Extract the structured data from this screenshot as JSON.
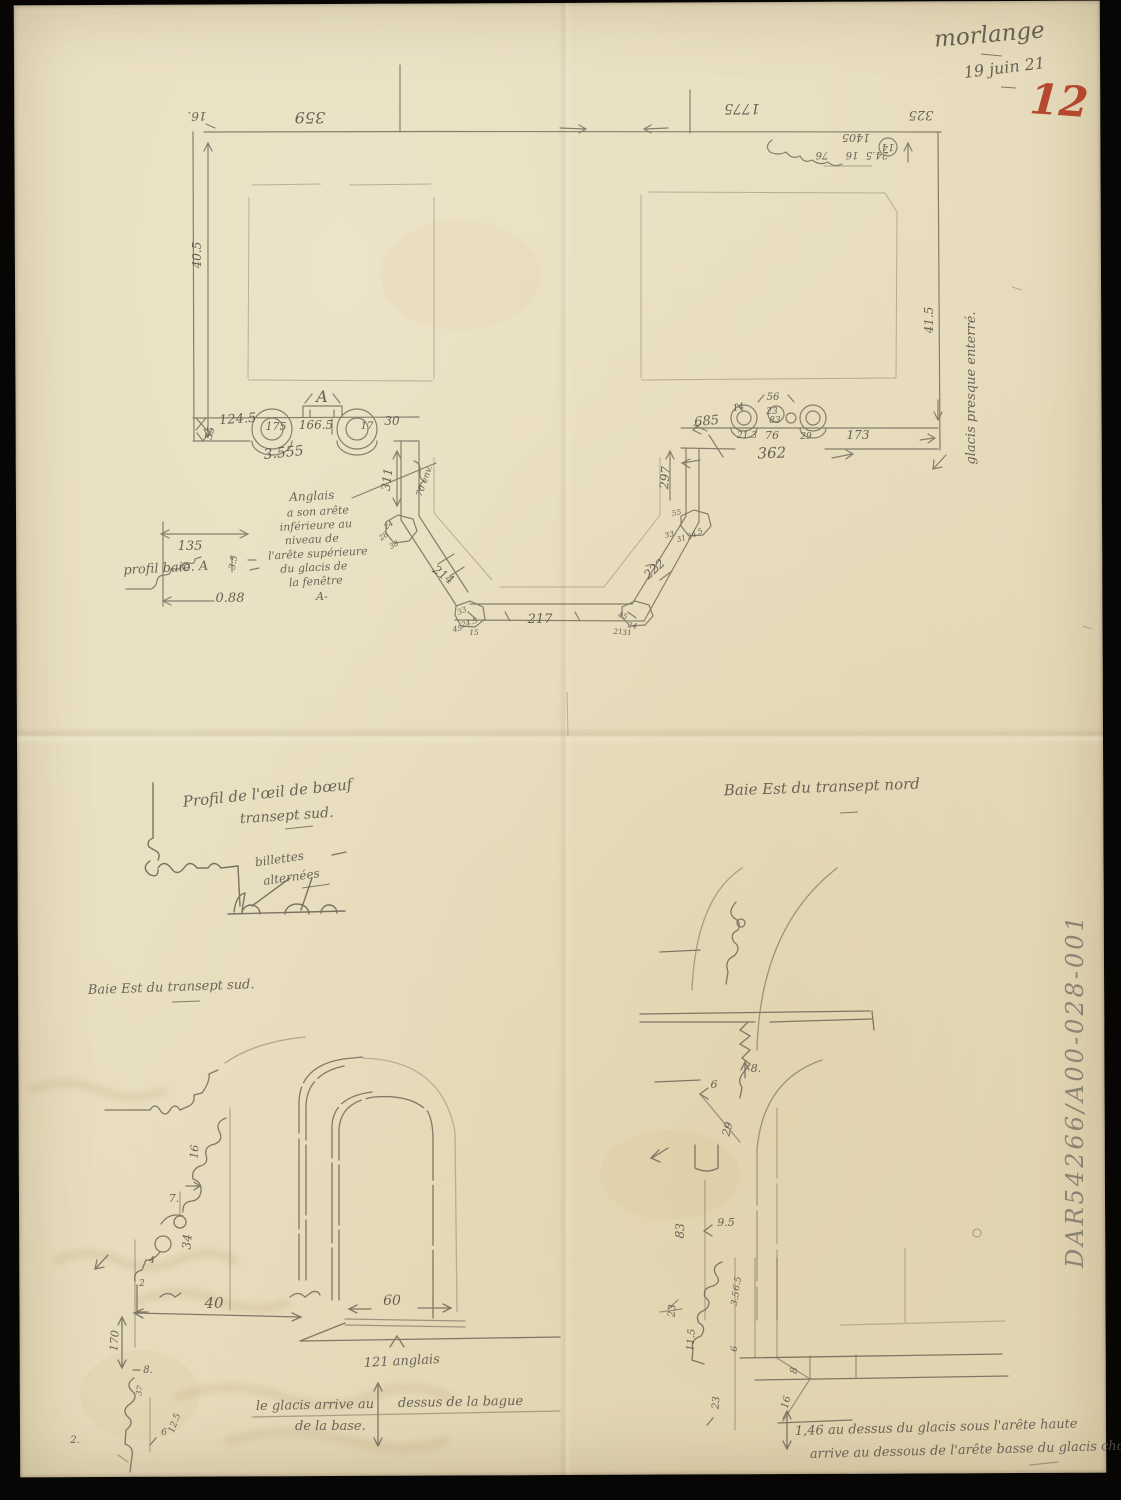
{
  "header": {
    "place": "morlange",
    "date": "19 juin 21",
    "folio": "12"
  },
  "archive": {
    "code": "DAR54266/A00-028-001"
  },
  "plan": {
    "dim_top_left": "16.",
    "dim_top_359": "359",
    "dim_top_1775": "1775",
    "dim_top_325": "325",
    "dim_top_1405": "1405",
    "dim_top_76": "76",
    "dim_top_16": "16",
    "dim_top_245": "24.5",
    "dim_top_14": "14",
    "dim_left_wall": "40.5",
    "dim_right_wall": "41.5",
    "note_glacis_enterre": "glacis presque enterré.",
    "label_A": "A",
    "dim_1245": "124.5",
    "dim_175": "175",
    "dim_1665": "166.5",
    "dim_17": "17",
    "dim_30": "30",
    "dim_3555": "3.555",
    "dim_55": "55",
    "dim_311": "311",
    "dim_70env": "70 env.",
    "dim_685": "685",
    "dim_56": "56",
    "dim_14r": "14",
    "dim_23r": "23",
    "dim_83r": "83",
    "dim_213": "21.3",
    "dim_76r": "76",
    "dim_29r": "29",
    "dim_173": "173",
    "dim_362": "362",
    "dim_297": "297",
    "dim_214": "214",
    "dim_217": "217",
    "dim_222": "222",
    "butt_lt": [
      "24",
      "28",
      "38"
    ],
    "butt_lb": [
      "33",
      "24.5",
      "45",
      "15"
    ],
    "butt_rt": [
      "55",
      "33",
      "31",
      "24.5"
    ],
    "butt_rb": [
      "45",
      "24",
      "31",
      "21"
    ],
    "note_anglais_lines": [
      "Anglais",
      "a son arête",
      "inférieure au",
      "niveau de",
      "l'arête supérieure",
      "du glacis de",
      "la fenêtre",
      "A-"
    ],
    "profil_baie": {
      "dim_135": "135",
      "dim_35": "3.5",
      "label": "profil baie. A",
      "dim_088": "0.88"
    }
  },
  "oeil": {
    "title_l1": "Profil de l'œil de bœuf",
    "title_l2": "transept sud.",
    "lbl_billettes_1": "billettes",
    "lbl_billettes_2": "alternées"
  },
  "baie_sud": {
    "title": "Baie Est du transept sud.",
    "d16": "16",
    "d7": "7.",
    "d34": "34",
    "d4": "4",
    "d2": "2",
    "d40": "40",
    "d170": "170",
    "d8": "8.",
    "d37": "37",
    "d6": "6",
    "d125": "12.5",
    "d2b": "2.",
    "d60": "60",
    "d121": "121 anglais",
    "note_1a": "le glacis arrive au",
    "note_1b": "dessus de la bague",
    "note_2": "de la base."
  },
  "baie_nord": {
    "title": "Baie Est du transept nord",
    "d8": "8.",
    "d6": "6",
    "d29": "29",
    "d83": "83",
    "d95": "9.5",
    "d65": "6.5",
    "d35": "3.5",
    "d23a": "23",
    "d115": "11.5",
    "d6b": "6",
    "d23b": "23",
    "d8b": "8",
    "d16": "16",
    "note_l1": "1,46 au dessus du glacis sous l'arête haute",
    "note_l2": "arrive au dessous de l'arête basse du glacis chœur."
  }
}
